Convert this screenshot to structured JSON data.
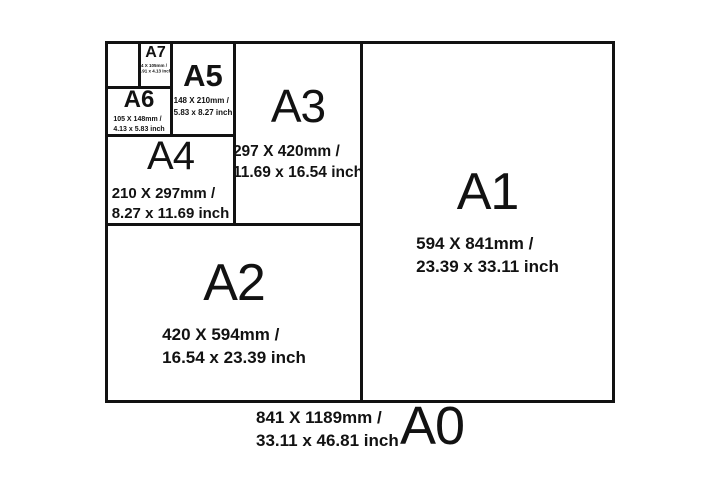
{
  "colors": {
    "line": "#121212",
    "background": "#ffffff",
    "text": "#121212"
  },
  "papers": [
    {
      "id": "a0",
      "label": "A0",
      "size_mm": "841 X 1189mm /",
      "size_inch": "33.11 x 46.81 inch"
    },
    {
      "id": "a1",
      "label": "A1",
      "size_mm": "594 X 841mm /",
      "size_inch": "23.39 x 33.11 inch"
    },
    {
      "id": "a2",
      "label": "A2",
      "size_mm": "420 X 594mm /",
      "size_inch": "16.54 x 23.39 inch"
    },
    {
      "id": "a3",
      "label": "A3",
      "size_mm": "297 X 420mm /",
      "size_inch": "11.69 x 16.54 inch"
    },
    {
      "id": "a4",
      "label": "A4",
      "size_mm": "210 X 297mm /",
      "size_inch": "8.27 x 11.69 inch"
    },
    {
      "id": "a5",
      "label": "A5",
      "size_mm": "148 X 210mm /",
      "size_inch": "5.83 x 8.27 inch"
    },
    {
      "id": "a6",
      "label": "A6",
      "size_mm": "105 X 148mm /",
      "size_inch": "4.13 x 5.83 inch"
    },
    {
      "id": "a7",
      "label": "A7",
      "size_mm": "74 X 105mm /",
      "size_inch": "2.91 x 4.13 inch"
    }
  ]
}
